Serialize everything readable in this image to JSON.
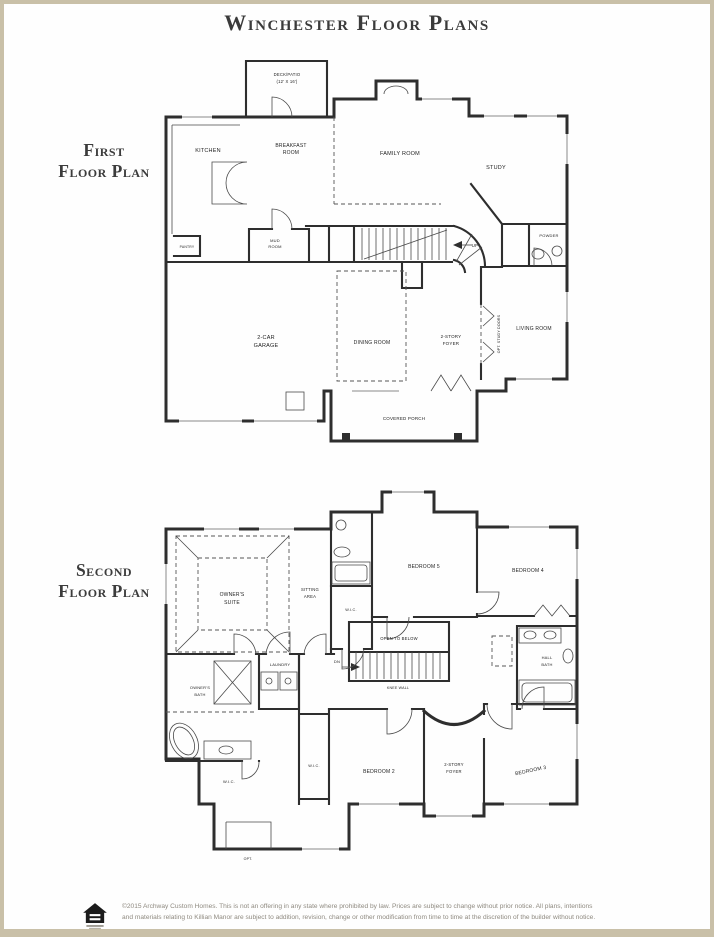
{
  "title": "Winchester Floor Plans",
  "first_floor": {
    "heading": {
      "line1": "First",
      "line2": "Floor Plan"
    },
    "rooms": {
      "deck_patio_line1": "DECK/PATIO",
      "deck_patio_line2": "(12' X 16')",
      "kitchen": "KITCHEN",
      "breakfast_line1": "BREAKFAST",
      "breakfast_line2": "ROOM",
      "family_room": "FAMILY ROOM",
      "study": "STUDY",
      "powder": "POWDER",
      "mud_room_line1": "MUD",
      "mud_room_line2": "ROOM",
      "pantry": "PANTRY",
      "garage_line1": "2-CAR",
      "garage_line2": "GARAGE",
      "dining_room": "DINING ROOM",
      "foyer_line1": "2-STORY",
      "foyer_line2": "FOYER",
      "living_room": "LIVING ROOM",
      "opt_study_doors": "OPT. STUDY DOORS",
      "covered_porch": "COVERED PORCH",
      "up": "UP"
    }
  },
  "second_floor": {
    "heading": {
      "line1": "Second",
      "line2": "Floor Plan"
    },
    "rooms": {
      "owners_suite_line1": "OWNER'S",
      "owners_suite_line2": "SUITE",
      "sitting_area_line1": "SITTING",
      "sitting_area_line2": "AREA",
      "bedroom5": "BEDROOM 5",
      "bedroom4": "BEDROOM 4",
      "wic_bedroom5": "W.I.C.",
      "open_to_below": "OPEN TO BELOW",
      "knee_wall": "KNEE WALL",
      "dn": "DN",
      "laundry": "LAUNDRY",
      "owners_bath_line1": "OWNER'S",
      "owners_bath_line2": "BATH",
      "hall_bath_line1": "HALL",
      "hall_bath_line2": "BATH",
      "wic_owners": "W.I.C.",
      "wic_bedroom2": "W.I.C.",
      "bedroom2": "BEDROOM 2",
      "foyer_line1": "2-STORY",
      "foyer_line2": "FOYER",
      "bedroom3": "BEDROOM 3",
      "opt": "OPT."
    }
  },
  "footer": {
    "disclaimer_line1": "©2015 Archway Custom Homes. This is not an offering in any state where prohibited by law. Prices are subject to change without prior notice. All plans, intentions",
    "disclaimer_line2": "and materials relating to Killian Manor are subject to addition, revision, change or other modification from time to time at the discretion of the builder without notice.",
    "icons": {
      "equal_housing": "equal-housing-logo"
    }
  },
  "colors": {
    "frame": "#c9c0a8",
    "walls": "#2e2e2e",
    "heading_text": "#3c3c3c",
    "disclaimer_text": "#8f8a80"
  }
}
